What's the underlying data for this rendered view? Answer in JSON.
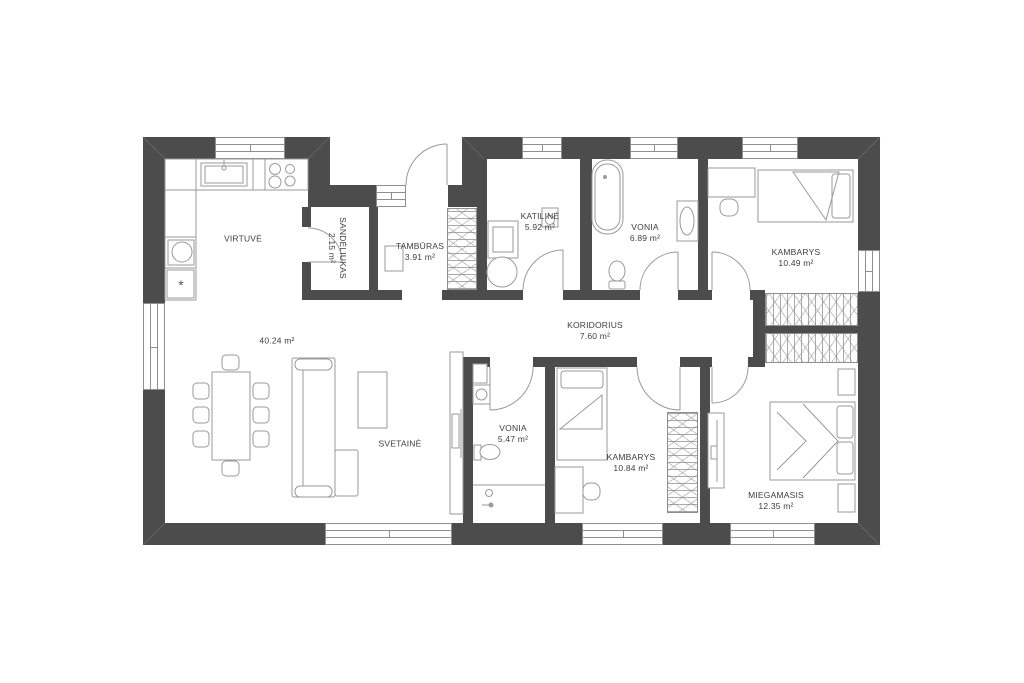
{
  "plan_title": "floor-plan",
  "rooms": [
    {
      "id": "virtuve",
      "name": "VIRTUVĖ",
      "area": ""
    },
    {
      "id": "open-area",
      "name": "",
      "area": "40.24 m²"
    },
    {
      "id": "svetaine",
      "name": "SVETAINĖ",
      "area": ""
    },
    {
      "id": "sandeliukas",
      "name": "SANDĖLIUKAS",
      "area": "2.15 m²"
    },
    {
      "id": "tamburas",
      "name": "TAMBŪRAS",
      "area": "3.91 m²"
    },
    {
      "id": "katiline",
      "name": "KATILINĖ",
      "area": "5.92 m²"
    },
    {
      "id": "vonia-1",
      "name": "VONIA",
      "area": "6.89 m²"
    },
    {
      "id": "kambarys-1",
      "name": "KAMBARYS",
      "area": "10.49 m²"
    },
    {
      "id": "koridorius",
      "name": "KORIDORIUS",
      "area": "7.60 m²"
    },
    {
      "id": "vonia-2",
      "name": "VONIA",
      "area": "5.47 m²"
    },
    {
      "id": "kambarys-2",
      "name": "KAMBARYS",
      "area": "10.84 m²"
    },
    {
      "id": "miegamasis",
      "name": "MIEGAMASIS",
      "area": "12.35 m²"
    }
  ],
  "symbols": {
    "fridge": "*"
  },
  "colors": {
    "wall": "#4c4c4c",
    "furniture_line": "#9a9a9a",
    "text": "#3e3e3e",
    "background": "#ffffff"
  }
}
